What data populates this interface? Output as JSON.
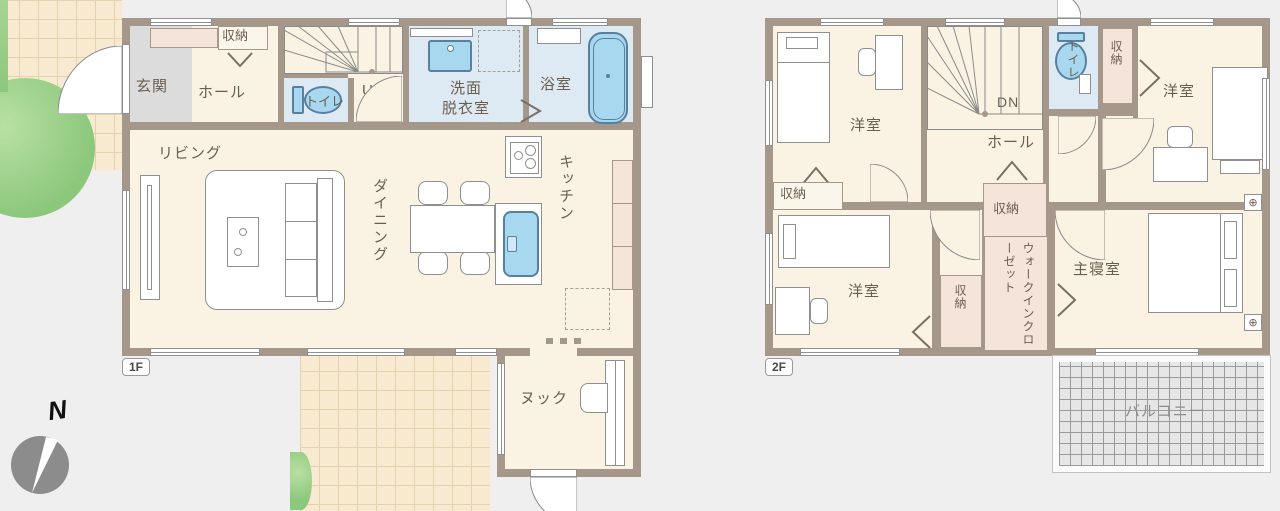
{
  "terms": {
    "entrance": "玄関",
    "hall": "ホール",
    "storage": "収納",
    "toilet": "トイレ",
    "up": "UP",
    "dn": "DN",
    "washroom_line1": "洗面",
    "washroom_line2": "脱衣室",
    "bath": "浴室",
    "living": "リビング",
    "dining": "ダイニング",
    "kitchen": "キッチン",
    "nook": "ヌック",
    "western_room": "洋室",
    "walk_in_closet": "ウォークインクローゼット",
    "master_bedroom": "主寝室",
    "balcony": "バルコニー"
  },
  "floors": {
    "f1_tag": "1F",
    "f2_tag": "2F"
  },
  "compass": {
    "north": "N"
  },
  "symbols": {
    "equipment": "⊕"
  },
  "colors": {
    "wall": "#a5978a",
    "floor": "#faf3e3",
    "wet_room": "#dde9f3",
    "fixture_blue": "#a8d8ef",
    "closet_pink": "#f5e4da",
    "tile": "#f7ead0",
    "balcony": "#e6e6e6",
    "greenery": "#8cc87c",
    "text": "#6b5e50"
  }
}
